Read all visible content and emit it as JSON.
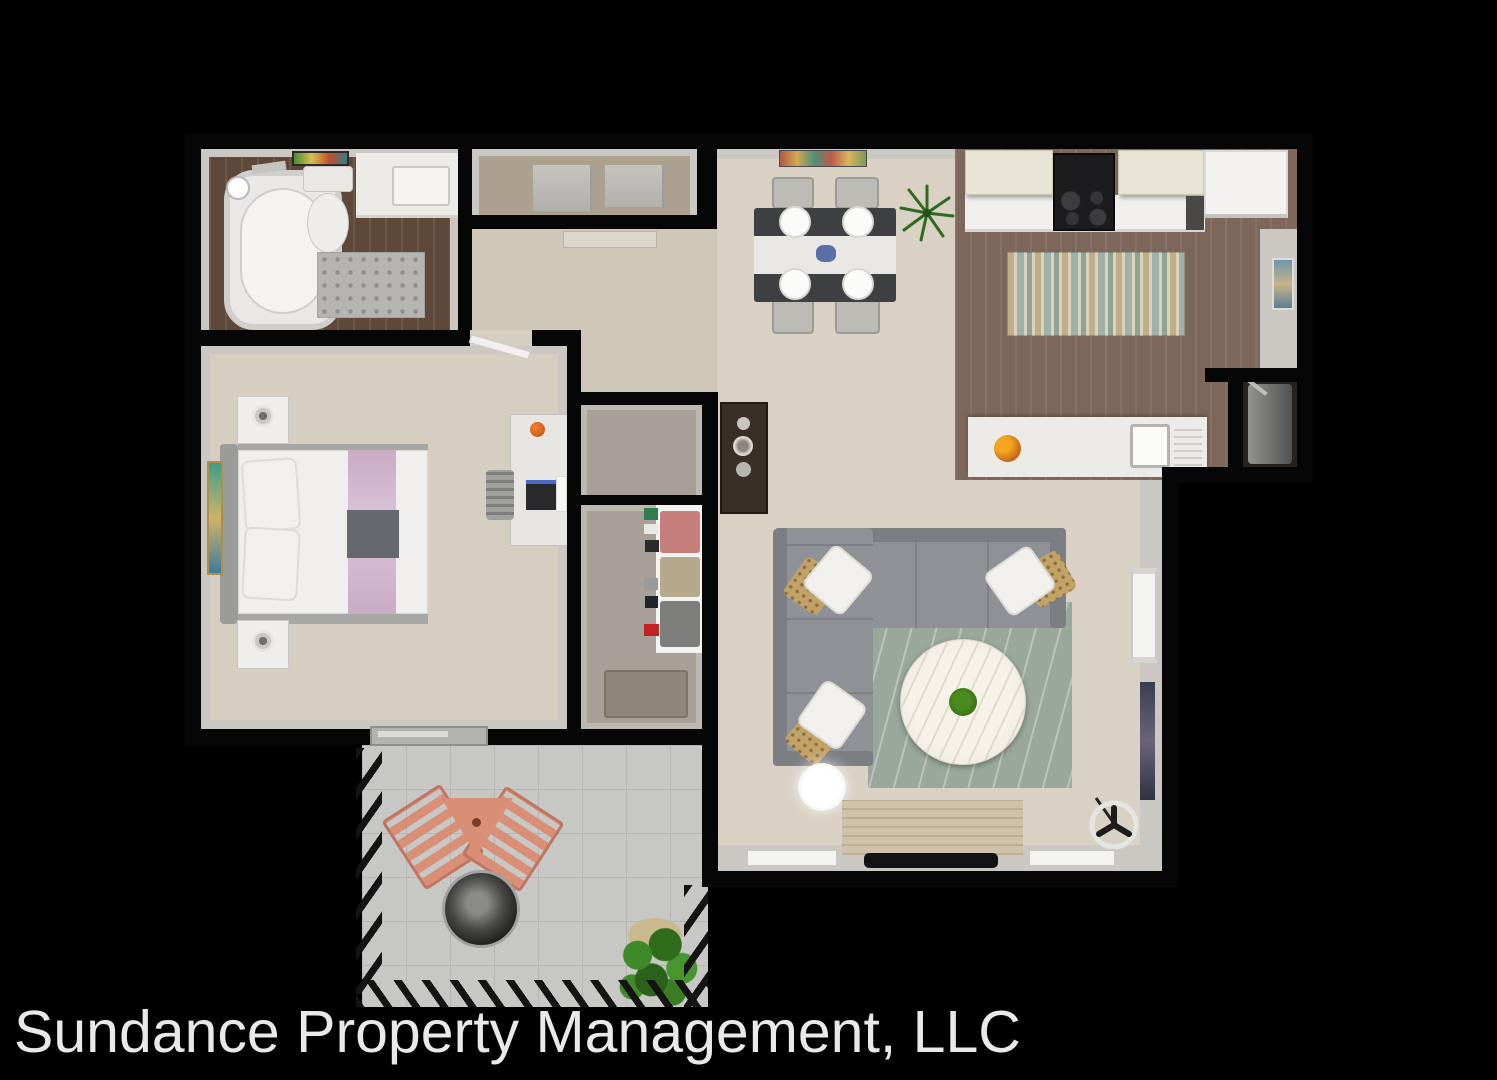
{
  "caption": {
    "text": "Sundance Property Management, LLC"
  },
  "colors": {
    "background": "#000000",
    "wall": "#060606",
    "wall_band": "#cbc8c3",
    "floor_beige": "#d8d1c4",
    "floor_beige_dark": "#cfc8b9",
    "floor_carpet": "#d6cfc1",
    "bath_wood": "#5e4839",
    "bath_wood_light": "#6f5846",
    "kitchen_wood": "#7d675a",
    "patio_concrete": "#c7c7c5",
    "patio_line": "#b6b6b4",
    "closet_gray": "#a6a098",
    "wd_floor": "#aca08e",
    "counter_white": "#edebe7",
    "cabinet_cream": "#e7e3d5",
    "stove_black": "#1c1c1e",
    "fridge_white": "#f3f2f0",
    "sofa_gray": "#8e9297",
    "sofa_gray_dark": "#7b7f84",
    "rug_sage": "#9aa89c",
    "rug_tan": "#c1ae86",
    "rug_blue": "#a0b1ac",
    "rug_cream": "#d9d2bc",
    "rug_bath": "#b5b4b0",
    "bed_purple": "#c9abc4",
    "bed_gray": "#65686d",
    "console_brown": "#392f27",
    "chair_salmon": "#d98e76",
    "chair_salmon_dark": "#bf7560",
    "plant_green": "#3f7d2b",
    "plant_green_dark": "#2c5e1b",
    "table_marble": "#f4efe6",
    "wood_console": "#cec2aa",
    "tv_black": "#131315",
    "firepit_rim": "#a2a2a0",
    "caption": "#e9e9e7",
    "white_fixture": "#efeeec",
    "fixture_border": "#c9c8c5"
  }
}
